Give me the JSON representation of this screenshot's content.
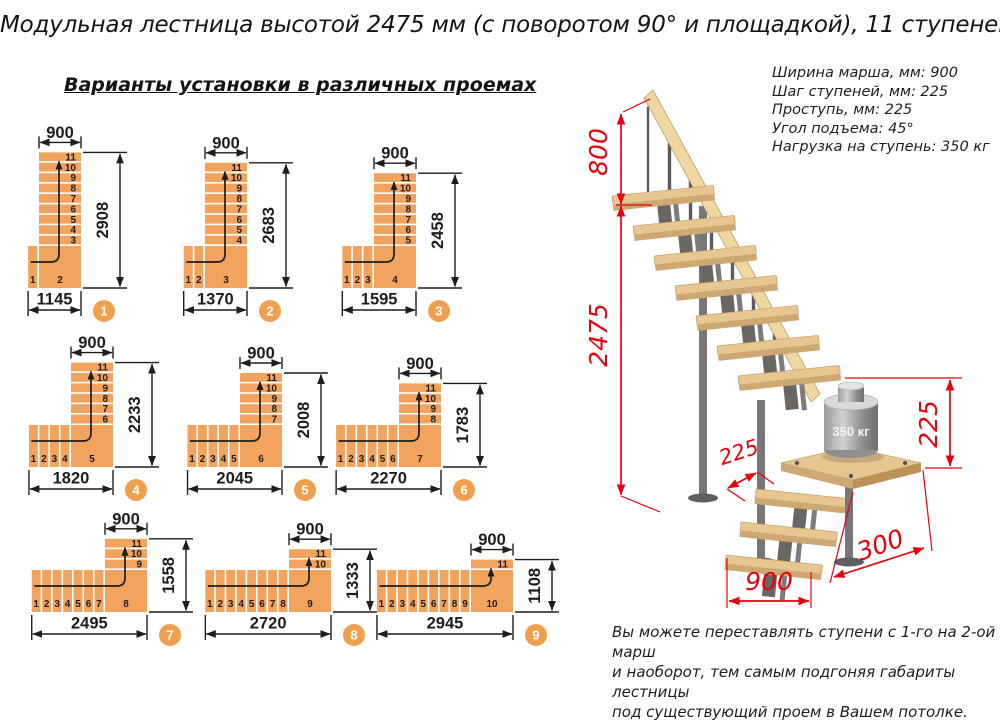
{
  "title": "Модульная лестница высотой 2475 мм (с поворотом 90° и площадкой), 11 ступеней",
  "subtitle": "Варианты установки в различных проемах",
  "specs": [
    "Ширина марша, мм: 900",
    "Шаг ступеней, мм: 225",
    "Проступь, мм: 225",
    "Угол подъема: 45°",
    "Нагрузка на ступень: 350 кг"
  ],
  "diagrams": [
    {
      "badge": "1",
      "flight_width": "900",
      "opening_height": "2908",
      "opening_width": "1145",
      "flight_steps": [
        "11",
        "10",
        "9",
        "8",
        "7",
        "6",
        "5",
        "4",
        "3"
      ],
      "bottom_steps": [
        "1"
      ],
      "corner_step": "2"
    },
    {
      "badge": "2",
      "flight_width": "900",
      "opening_height": "2683",
      "opening_width": "1370",
      "flight_steps": [
        "11",
        "10",
        "9",
        "8",
        "7",
        "6",
        "5",
        "4"
      ],
      "bottom_steps": [
        "1",
        "2"
      ],
      "corner_step": "3"
    },
    {
      "badge": "3",
      "flight_width": "900",
      "opening_height": "2458",
      "opening_width": "1595",
      "flight_steps": [
        "11",
        "10",
        "9",
        "8",
        "7",
        "6",
        "5"
      ],
      "bottom_steps": [
        "1",
        "2",
        "3"
      ],
      "corner_step": "4"
    },
    {
      "badge": "4",
      "flight_width": "900",
      "opening_height": "2233",
      "opening_width": "1820",
      "flight_steps": [
        "11",
        "10",
        "9",
        "8",
        "7",
        "6"
      ],
      "bottom_steps": [
        "1",
        "2",
        "3",
        "4"
      ],
      "corner_step": "5"
    },
    {
      "badge": "5",
      "flight_width": "900",
      "opening_height": "2008",
      "opening_width": "2045",
      "flight_steps": [
        "11",
        "10",
        "9",
        "8",
        "7"
      ],
      "bottom_steps": [
        "1",
        "2",
        "3",
        "4",
        "5"
      ],
      "corner_step": "6"
    },
    {
      "badge": "6",
      "flight_width": "900",
      "opening_height": "1783",
      "opening_width": "2270",
      "flight_steps": [
        "11",
        "10",
        "9",
        "8"
      ],
      "bottom_steps": [
        "1",
        "2",
        "3",
        "4",
        "5",
        "6"
      ],
      "corner_step": "7"
    },
    {
      "badge": "7",
      "flight_width": "900",
      "opening_height": "1558",
      "opening_width": "2495",
      "flight_steps": [
        "11",
        "10",
        "9"
      ],
      "bottom_steps": [
        "1",
        "2",
        "3",
        "4",
        "5",
        "6",
        "7"
      ],
      "corner_step": "8"
    },
    {
      "badge": "8",
      "flight_width": "900",
      "opening_height": "1333",
      "opening_width": "2720",
      "flight_steps": [
        "11",
        "10"
      ],
      "bottom_steps": [
        "1",
        "2",
        "3",
        "4",
        "5",
        "6",
        "7",
        "8"
      ],
      "corner_step": "9"
    },
    {
      "badge": "9",
      "flight_width": "900",
      "opening_height": "1108",
      "opening_width": "2945",
      "flight_steps": [
        "11"
      ],
      "bottom_steps": [
        "1",
        "2",
        "3",
        "4",
        "5",
        "6",
        "7",
        "8",
        "9"
      ],
      "corner_step": "10"
    }
  ],
  "stair3d": {
    "rail_height": "800",
    "total_height": "2475",
    "step_rise": "225",
    "platform_rise": "225",
    "march_width": "900",
    "platform_overhang": "300",
    "load_label": "350 кг"
  },
  "footnote": [
    "Вы можете переставлять ступени с 1-го на 2-ой марш",
    "и наоборот, тем самым подгоняя габариты лестницы",
    "под существующий проем в Вашем потолке."
  ],
  "colors": {
    "step": "#F2A45E",
    "badge": "#EFA04E",
    "dim": "#1d1d1d",
    "red": "#E8000D",
    "wood_top": "#E7C692",
    "wood_side": "#CDA873",
    "metal": "#777777"
  }
}
